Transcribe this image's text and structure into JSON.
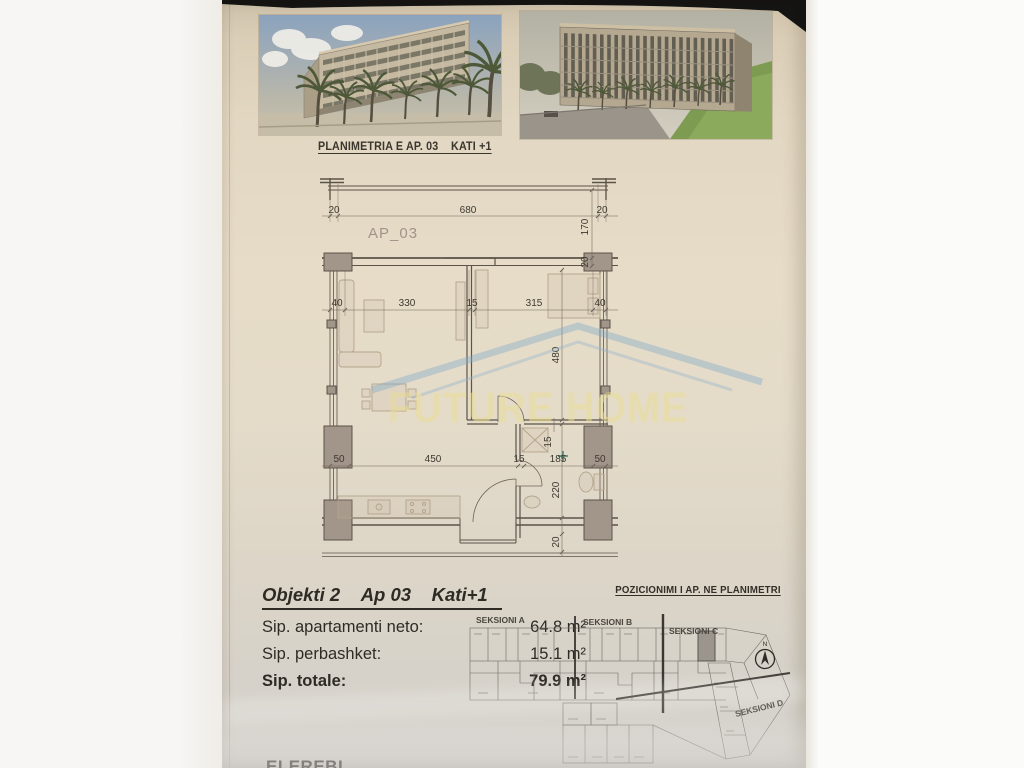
{
  "header": {
    "title": "PLANIMETRIA E AP. 03    KATI +1"
  },
  "images": {
    "left": "building-render-corner-view",
    "right": "building-render-facade-view"
  },
  "plan": {
    "unit_label": "AP_03",
    "dims": {
      "top": [
        "20",
        "680",
        "20"
      ],
      "right_upper": [
        "170",
        "20"
      ],
      "middle": [
        "40",
        "330",
        "15",
        "315",
        "40"
      ],
      "right_middle": [
        "480"
      ],
      "lower": [
        "50",
        "450",
        "15",
        "185",
        "50"
      ],
      "right_lower": [
        "15",
        "220",
        "20"
      ]
    },
    "watermark": {
      "text": "FUTURE HOME"
    }
  },
  "details": {
    "heading": "Objekti 2    Ap 03    Kati+1",
    "rows": [
      {
        "label": "Sip. apartamenti neto:",
        "value": "64.8 m²"
      },
      {
        "label": "Sip. perbashket:",
        "value": "15.1 m²"
      },
      {
        "label": "Sip. totale:",
        "value": "79.9 m²"
      }
    ]
  },
  "position_map": {
    "heading": "POZICIONIMI I AP. NE PLANIMETRI",
    "sections": [
      "SEKSIONI A",
      "SEKSIONI B",
      "SEKSIONI C",
      "SEKSIONI D"
    ],
    "compass_label": "N"
  },
  "cutoff_text": "ELEREBL",
  "colors": {
    "paper": "#e4dac6",
    "ink": "#2f2b24",
    "plan_line": "#5c544a",
    "column_fill": "#a2958a",
    "watermark_text": "#e9dfa8",
    "watermark_roof": "#7fa9c9",
    "highlight_cell": "#9b958d"
  }
}
